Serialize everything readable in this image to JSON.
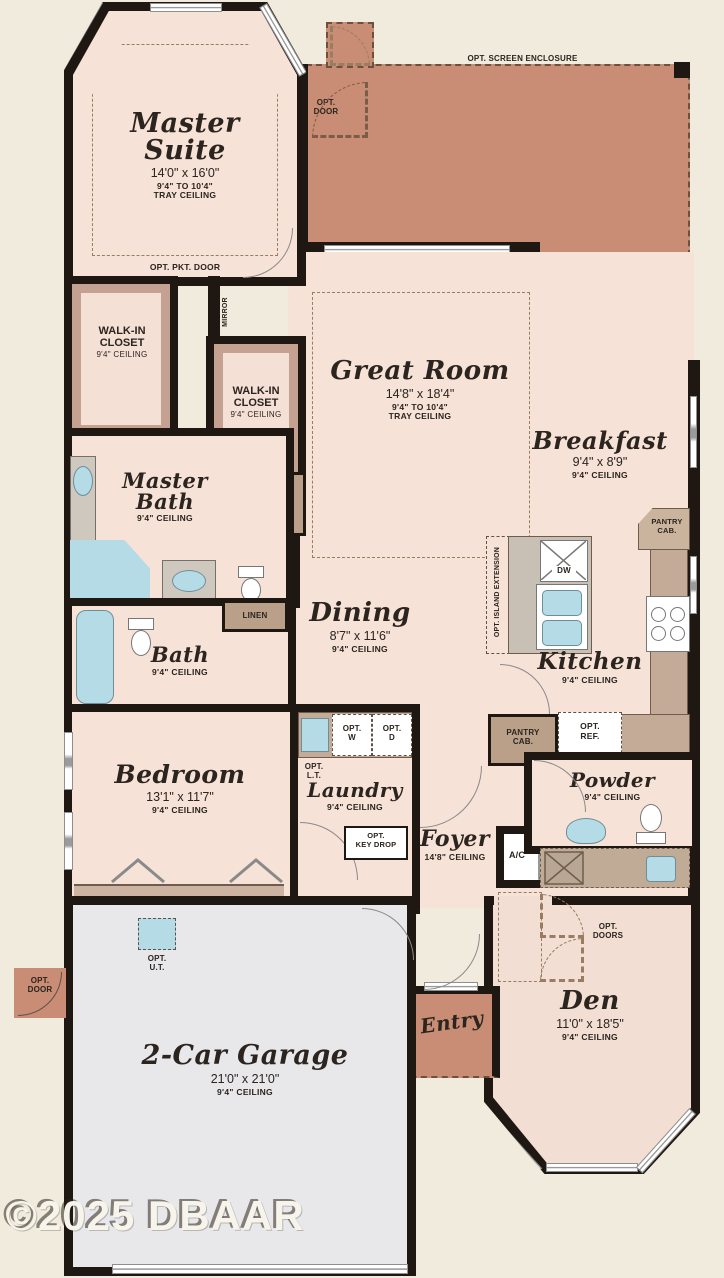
{
  "watermark": "©2025 DBAAR",
  "colors": {
    "background": "#f0ebdd",
    "floor": "#f6e2d7",
    "lanai": "#c88d74",
    "walls": "#1e1712",
    "garage_floor": "#e8e8ea",
    "cabinet": "#c3ab97",
    "fixture_blue": "#b4dbe6",
    "closet_trim": "#c4a191"
  },
  "rooms": {
    "master_suite": {
      "name": "Master Suite",
      "dims": "14'0\" x 16'0\"",
      "ceiling": "9'4\" TO 10'4\"\nTRAY CEILING"
    },
    "lanai": {
      "name": "Lanai",
      "dims": "24'8\" x 19'4\"",
      "ceiling": "9'4\" CEILING"
    },
    "great_room": {
      "name": "Great Room",
      "dims": "14'8\" x 18'4\"",
      "ceiling": "9'4\" TO 10'4\"\nTRAY CEILING"
    },
    "breakfast": {
      "name": "Breakfast",
      "dims": "9'4\" x 8'9\"",
      "ceiling": "9'4\" CEILING"
    },
    "kitchen": {
      "name": "Kitchen",
      "ceiling": "9'4\" CEILING"
    },
    "dining": {
      "name": "Dining",
      "dims": "8'7\" x 11'6\"",
      "ceiling": "9'4\" CEILING"
    },
    "master_bath": {
      "name": "Master Bath",
      "ceiling": "9'4\" CEILING"
    },
    "walk_in_closet_1": {
      "name": "WALK-IN\nCLOSET",
      "ceiling": "9'4\" CEILING"
    },
    "walk_in_closet_2": {
      "name": "WALK-IN\nCLOSET",
      "ceiling": "9'4\" CEILING"
    },
    "bath": {
      "name": "Bath",
      "ceiling": "9'4\" CEILING"
    },
    "bedroom": {
      "name": "Bedroom",
      "dims": "13'1\" x 11'7\"",
      "ceiling": "9'4\" CEILING"
    },
    "laundry": {
      "name": "Laundry",
      "ceiling": "9'4\" CEILING"
    },
    "foyer": {
      "name": "Foyer",
      "ceiling": "14'8\" CEILING"
    },
    "powder": {
      "name": "Powder",
      "ceiling": "9'4\" CEILING"
    },
    "den": {
      "name": "Den",
      "dims": "11'0\" x 18'5\"",
      "ceiling": "9'4\" CEILING"
    },
    "entry": {
      "name": "Entry"
    },
    "garage": {
      "name": "2-Car Garage",
      "dims": "21'0\" x 21'0\"",
      "ceiling": "9'4\" CEILING"
    }
  },
  "labels": {
    "opt_screen_enclosure": "OPT. SCREEN ENCLOSURE",
    "opt_door_lanai": "OPT.\nDOOR",
    "opt_pkt_door": "OPT. PKT. DOOR",
    "mirror": "MIRROR",
    "linen_vertical": "LINEN",
    "linen": "LINEN",
    "pantry_cab_upper": "PANTRY\nCAB.",
    "pantry_cab_lower": "PANTRY\nCAB.",
    "opt_island_extension": "OPT. ISLAND EXTENSION",
    "dw": "DW",
    "opt_ref": "OPT.\nREF.",
    "opt_lt": "OPT.\nL.T.",
    "opt_w": "OPT.\nW",
    "opt_d": "OPT.\nD",
    "opt_key_drop": "OPT.\nKEY DROP",
    "ac": "A/C",
    "opt_doors": "OPT.\nDOORS",
    "opt_ut": "OPT.\nU.T.",
    "opt_door_garage": "OPT.\nDOOR"
  }
}
